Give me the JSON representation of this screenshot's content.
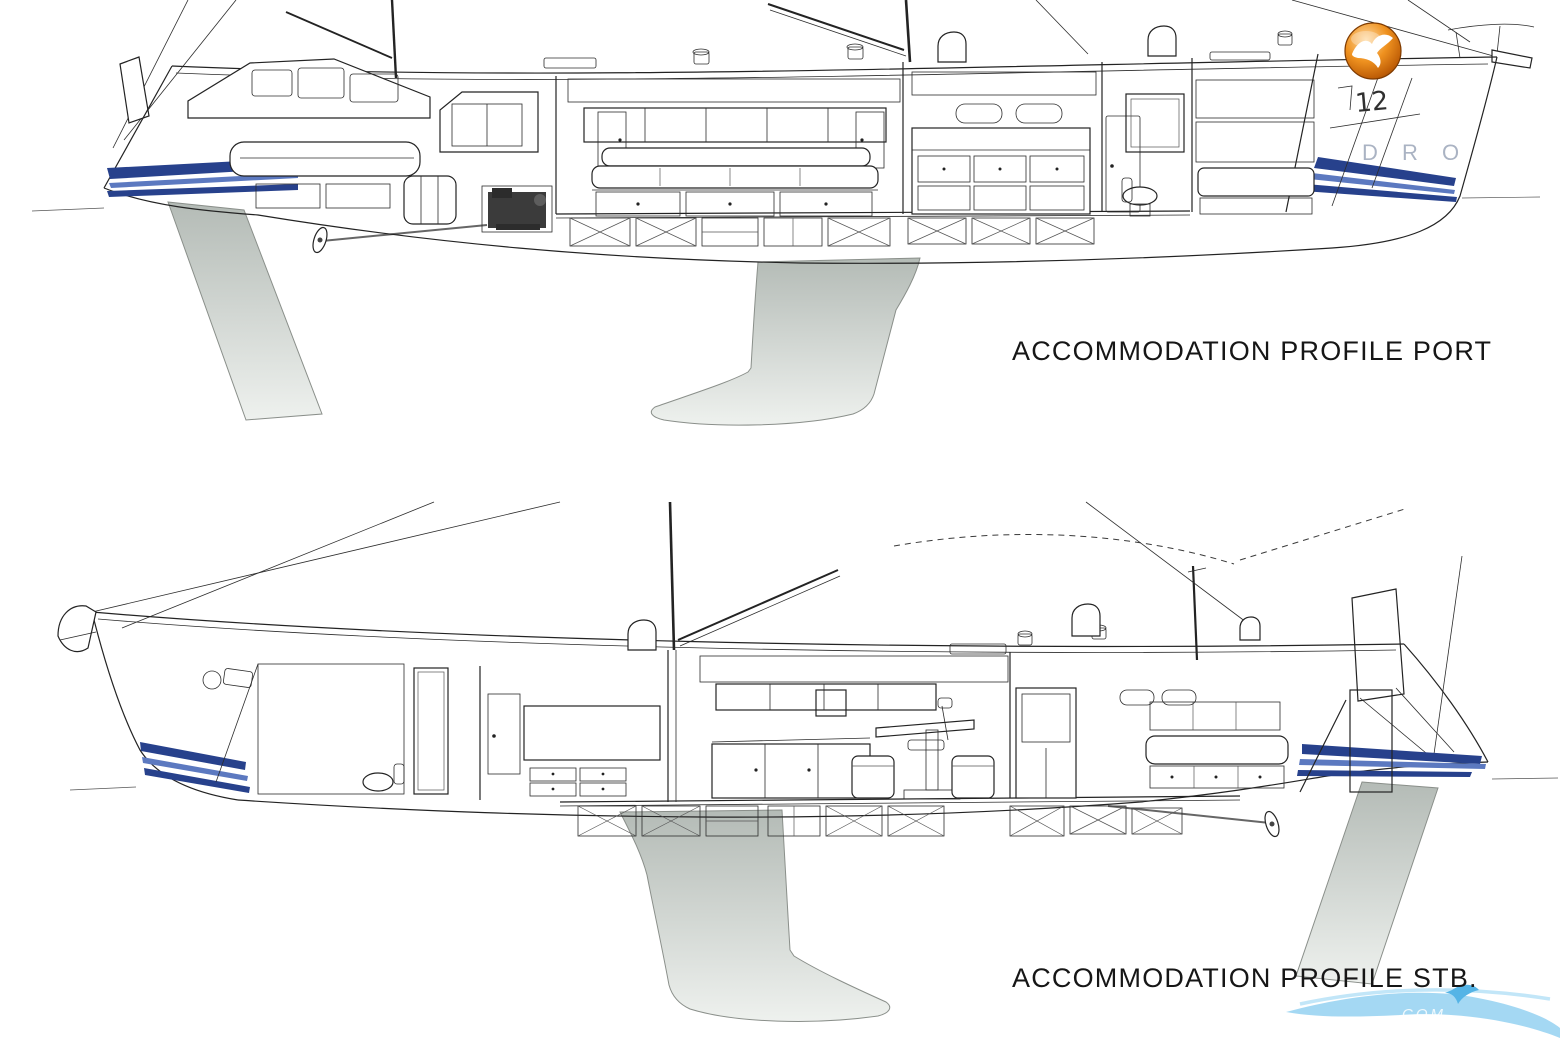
{
  "page": {
    "background_color": "#ffffff"
  },
  "drawings": {
    "port": {
      "caption": "ACCOMMODATION PROFILE PORT"
    },
    "stb": {
      "caption": "ACCOMMODATION PROFILE STB."
    }
  },
  "annotations": {
    "hull_marking": "12",
    "watermark_letters": "D R O",
    "swoosh_text": "COM"
  },
  "logo": {
    "icon": "gull-logo-icon",
    "ball_color": "#e08617",
    "bird_color": "#ffffff"
  },
  "colors": {
    "line": "#232323",
    "stripe_navy": "#27418c",
    "stripe_light": "#5c79c0",
    "keel_grey_dark": "#b4bbb6",
    "keel_grey_light": "#eef1ee",
    "watermark_blue": "#9ad4f2",
    "caption_text": "#161616"
  }
}
